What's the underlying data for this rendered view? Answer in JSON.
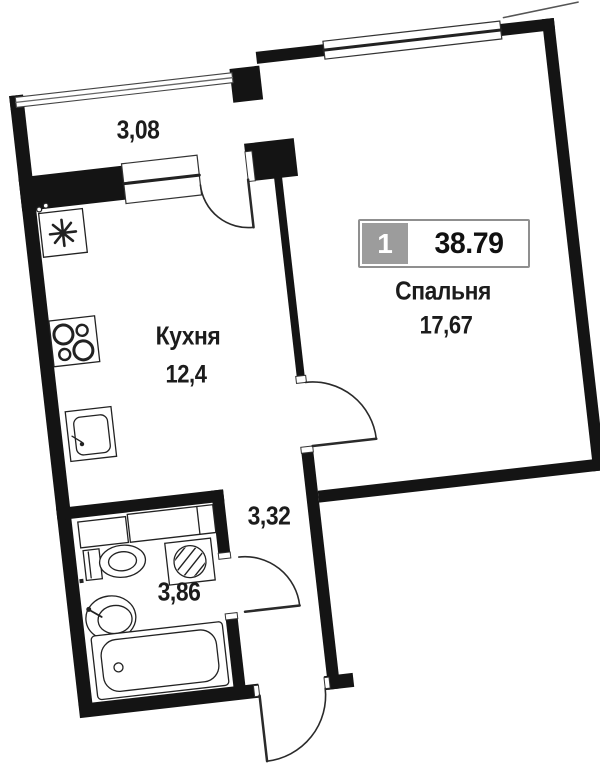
{
  "plan_badge": {
    "room_count": "1",
    "total_area": "38.79"
  },
  "rooms": {
    "balcony": {
      "area": "3,08"
    },
    "bedroom": {
      "name": "Спальня",
      "area": "17,67"
    },
    "kitchen": {
      "name": "Кухня",
      "area": "12,4"
    },
    "hallway": {
      "area": "3,32"
    },
    "bathroom": {
      "area": "3,86"
    }
  },
  "colors": {
    "wall": "#141414",
    "text": "#1c1c1c",
    "badge_fill": "#9c9c9c",
    "badge_border": "#8f8f8f",
    "badge_number_text": "#ffffff",
    "badge_area_text": "#111111"
  },
  "icons": {
    "windows": [
      "balcony-glazing",
      "kitchen-window",
      "bedroom-window"
    ],
    "doors": [
      "balcony-door",
      "bedroom-door",
      "bathroom-door",
      "entrance-door"
    ],
    "fixtures": [
      "ventilation",
      "stove",
      "kitchen-sink",
      "cabinet",
      "washing-machine",
      "toilet",
      "bathroom-sink",
      "bathtub"
    ]
  }
}
